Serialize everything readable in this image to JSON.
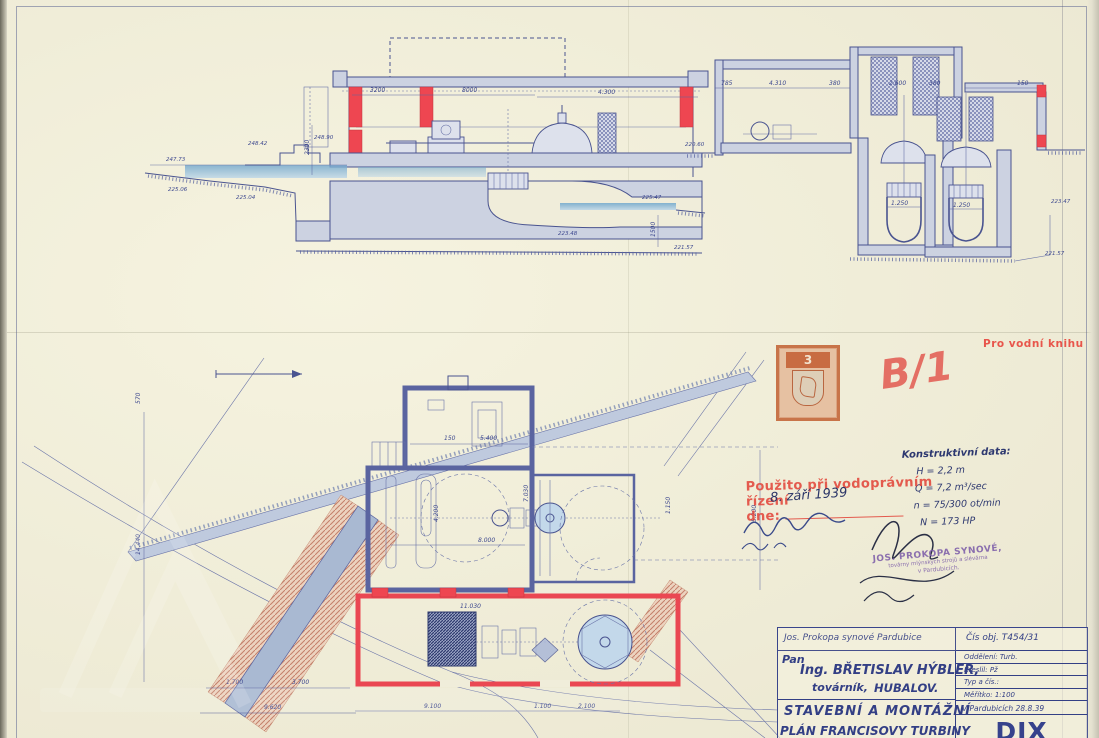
{
  "annotations": {
    "water_book_note": "Pro vodní knihu",
    "red_mark": "B/1",
    "revenue_stamp_value": "3",
    "approval_stamp_line1": "Použito při vodoprávním řízení",
    "approval_stamp_line2": "dne:",
    "approval_date_handwritten": "8. září 1939",
    "maker_stamp_line1": "JOS. PROKOPA SYNOVÉ,",
    "maker_stamp_line2": "továrny mlýnských strojů a slévárna",
    "maker_stamp_line3": "v Pardubicích."
  },
  "construction_data": {
    "heading": "Konstruktivní data:",
    "items": [
      "H = 2,2 m",
      "Q = 7,2 m³/sec",
      "n = 75/300 ot/min",
      "N = 173 HP"
    ]
  },
  "title_block": {
    "firm": "Jos. Prokopa synové  Pardubice",
    "order_no": "Čís obj. T454/31",
    "client_prefix": "Pan",
    "client_name": "Ing. BŘETISLAV HÝBLER,",
    "client_role": "továrník,",
    "client_place": "HUBALOV.",
    "dept": "Oddělení: Turb.",
    "drawn": "Kreslil: Pž",
    "type_no": "Typ a čís.:",
    "scale": "Měřítko: 1:100",
    "place_date": "V Pardubicích 28.8.39",
    "title_line1": "STAVEBNÍ A MONTÁŽNÍ",
    "title_line2": "PLÁN FRANCISOVY TURBINY",
    "drawing_no": "DIX 2006"
  },
  "drawings": {
    "section_long": {
      "dims": [
        "3200",
        "8000",
        "4.300",
        "2300",
        "1500"
      ],
      "elevations": [
        "247.73",
        "248.42",
        "248.90",
        "225.06",
        "225.04",
        "225.47",
        "223.48",
        "221.57"
      ]
    },
    "section_cross": {
      "dims": [
        "785",
        "4.310",
        "380",
        "2.600",
        "380",
        "150",
        "1.250",
        "1.250"
      ],
      "elevations": [
        "220.60",
        "223.47",
        "221.57"
      ]
    },
    "plan": {
      "dims": [
        "5.400",
        "150",
        "8.000",
        "4.200",
        "7.030",
        "11.030",
        "9.100",
        "1.100",
        "2.100",
        "14.440",
        "570",
        "1.700",
        "3.700",
        "9.620",
        "1.150",
        "5.200"
      ]
    }
  }
}
